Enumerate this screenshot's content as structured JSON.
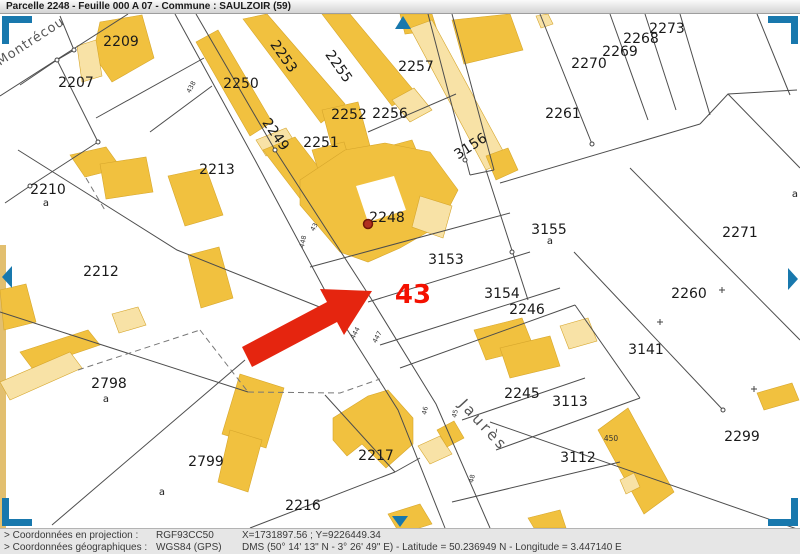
{
  "header": {
    "title": "Parcelle 2248 - Feuille 000 A 07 - Commune : SAULZOIR (59)"
  },
  "statusbar": {
    "rows": [
      {
        "label": "> Coordonnées en projection :",
        "system": "RGF93CC50",
        "value": "X=1731897.56 ; Y=9226449.34"
      },
      {
        "label": "> Coordonnées géographiques :",
        "system": "WGS84 (GPS)",
        "value": "DMS (50° 14' 13\" N - 3° 26' 49\" E) - Latitude = 50.236949 N - Longitude = 3.447140 E"
      }
    ]
  },
  "map": {
    "highlight": {
      "parcel_text": "43",
      "marker_parcel": "2248"
    },
    "street_names": [
      {
        "text": "Montrécou"
      },
      {
        "text": "Jaurès"
      }
    ],
    "parcel_labels": [
      {
        "text": "2209"
      },
      {
        "text": "2207"
      },
      {
        "text": "2210"
      },
      {
        "text": "2212"
      },
      {
        "text": "2213"
      },
      {
        "text": "2250"
      },
      {
        "text": "2253"
      },
      {
        "text": "2255"
      },
      {
        "text": "2249"
      },
      {
        "text": "2251"
      },
      {
        "text": "2252"
      },
      {
        "text": "2256"
      },
      {
        "text": "2257"
      },
      {
        "text": "3156"
      },
      {
        "text": "2261"
      },
      {
        "text": "2270"
      },
      {
        "text": "2269"
      },
      {
        "text": "2268"
      },
      {
        "text": "2273"
      },
      {
        "text": "2248"
      },
      {
        "text": "3153"
      },
      {
        "text": "3154"
      },
      {
        "text": "2246"
      },
      {
        "text": "3155"
      },
      {
        "text": "2271"
      },
      {
        "text": "2260"
      },
      {
        "text": "3141"
      },
      {
        "text": "2299"
      },
      {
        "text": "2245"
      },
      {
        "text": "3113"
      },
      {
        "text": "3112"
      },
      {
        "text": "2798"
      },
      {
        "text": "2799"
      },
      {
        "text": "2217"
      },
      {
        "text": "2216"
      }
    ],
    "sub_labels": [
      {
        "text": "a"
      },
      {
        "text": "a"
      },
      {
        "text": "a"
      },
      {
        "text": "a"
      },
      {
        "text": "a"
      }
    ],
    "road_numbers": [
      {
        "text": "438"
      },
      {
        "text": "43"
      },
      {
        "text": "448"
      },
      {
        "text": "444"
      },
      {
        "text": "447"
      },
      {
        "text": "46"
      },
      {
        "text": "45"
      },
      {
        "text": "48"
      },
      {
        "text": "450"
      }
    ],
    "colors": {
      "building": "#F1C13F",
      "building_light": "#F8E2A6",
      "boundary_line": "#4d4d4d",
      "arrow_red": "#E5250F",
      "marker_dot": "#B03020",
      "highlight_red": "#F41000",
      "ui_blue": "#1878AD",
      "left_margin_tan": "#E2BF6F"
    }
  }
}
